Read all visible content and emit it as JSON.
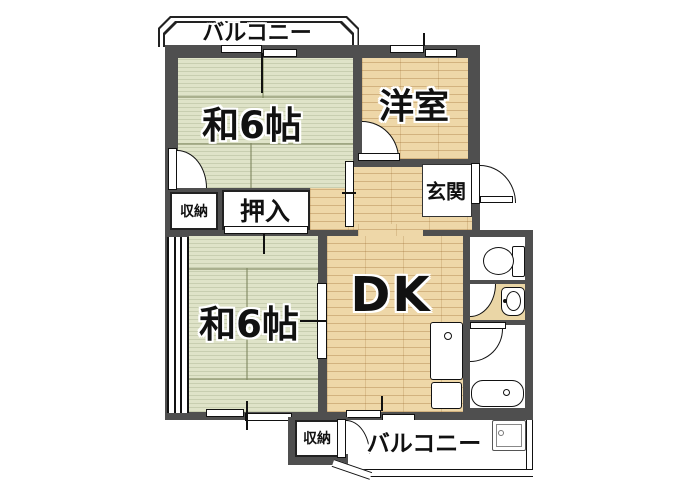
{
  "title": "2DK apartment floor plan",
  "labels": {
    "balcony_top": "バルコニー",
    "washitsu_upper": "和6帖",
    "yoshitsu": "洋室",
    "genkan": "玄関",
    "shuno_upper": "収納",
    "oshiire": "押入",
    "washitsu_lower": "和6帖",
    "dk": "DK",
    "shuno_lower": "収納",
    "balcony_bottom": "バルコニー"
  },
  "colors": {
    "wall": "#4f4f4f",
    "tatami": "#dfe3c8",
    "wood": "#eed7a8",
    "service": "#ead6a6",
    "outline": "#111111"
  },
  "fixtures": [
    "toilet-icon",
    "washbasin-icon",
    "bathtub-icon",
    "kitchen-sink-icon",
    "kitchen-counter-icon",
    "washing-machine-pan-icon"
  ]
}
